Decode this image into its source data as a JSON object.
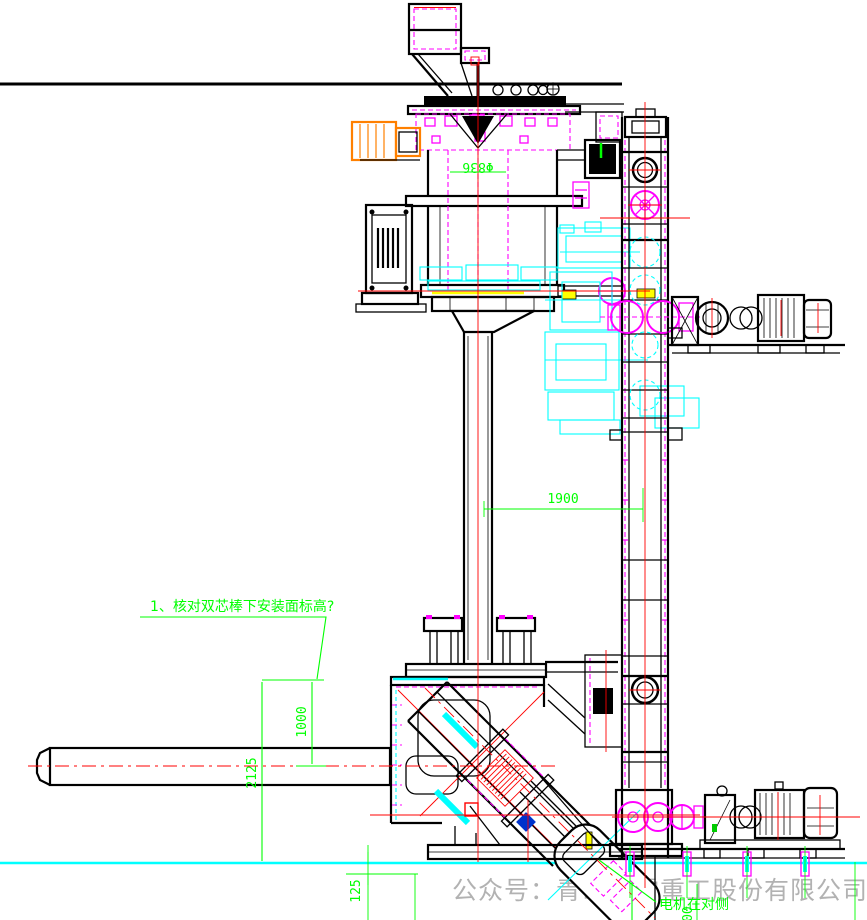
{
  "dims": {
    "dia836": "Φ836",
    "span1900": "1900",
    "h1000": "1000",
    "h2125": "2125",
    "h125": "125",
    "h200": "200"
  },
  "annotations": {
    "note1": "1、核对双芯棒下安装面标高?",
    "note2": "电机在对侧"
  },
  "watermark": {
    "label": "公众号：青岛雷霆重工股份有限公司"
  },
  "colors": {
    "outline": "#000000",
    "detail": "#ff00ff",
    "phantom": "#00ffff",
    "centerline": "#ff0000",
    "dimension": "#00ff00",
    "highlight": "#ffff00",
    "motor": "#ff8000",
    "watermark": "#b2b2b2",
    "background": "#ffffff"
  }
}
